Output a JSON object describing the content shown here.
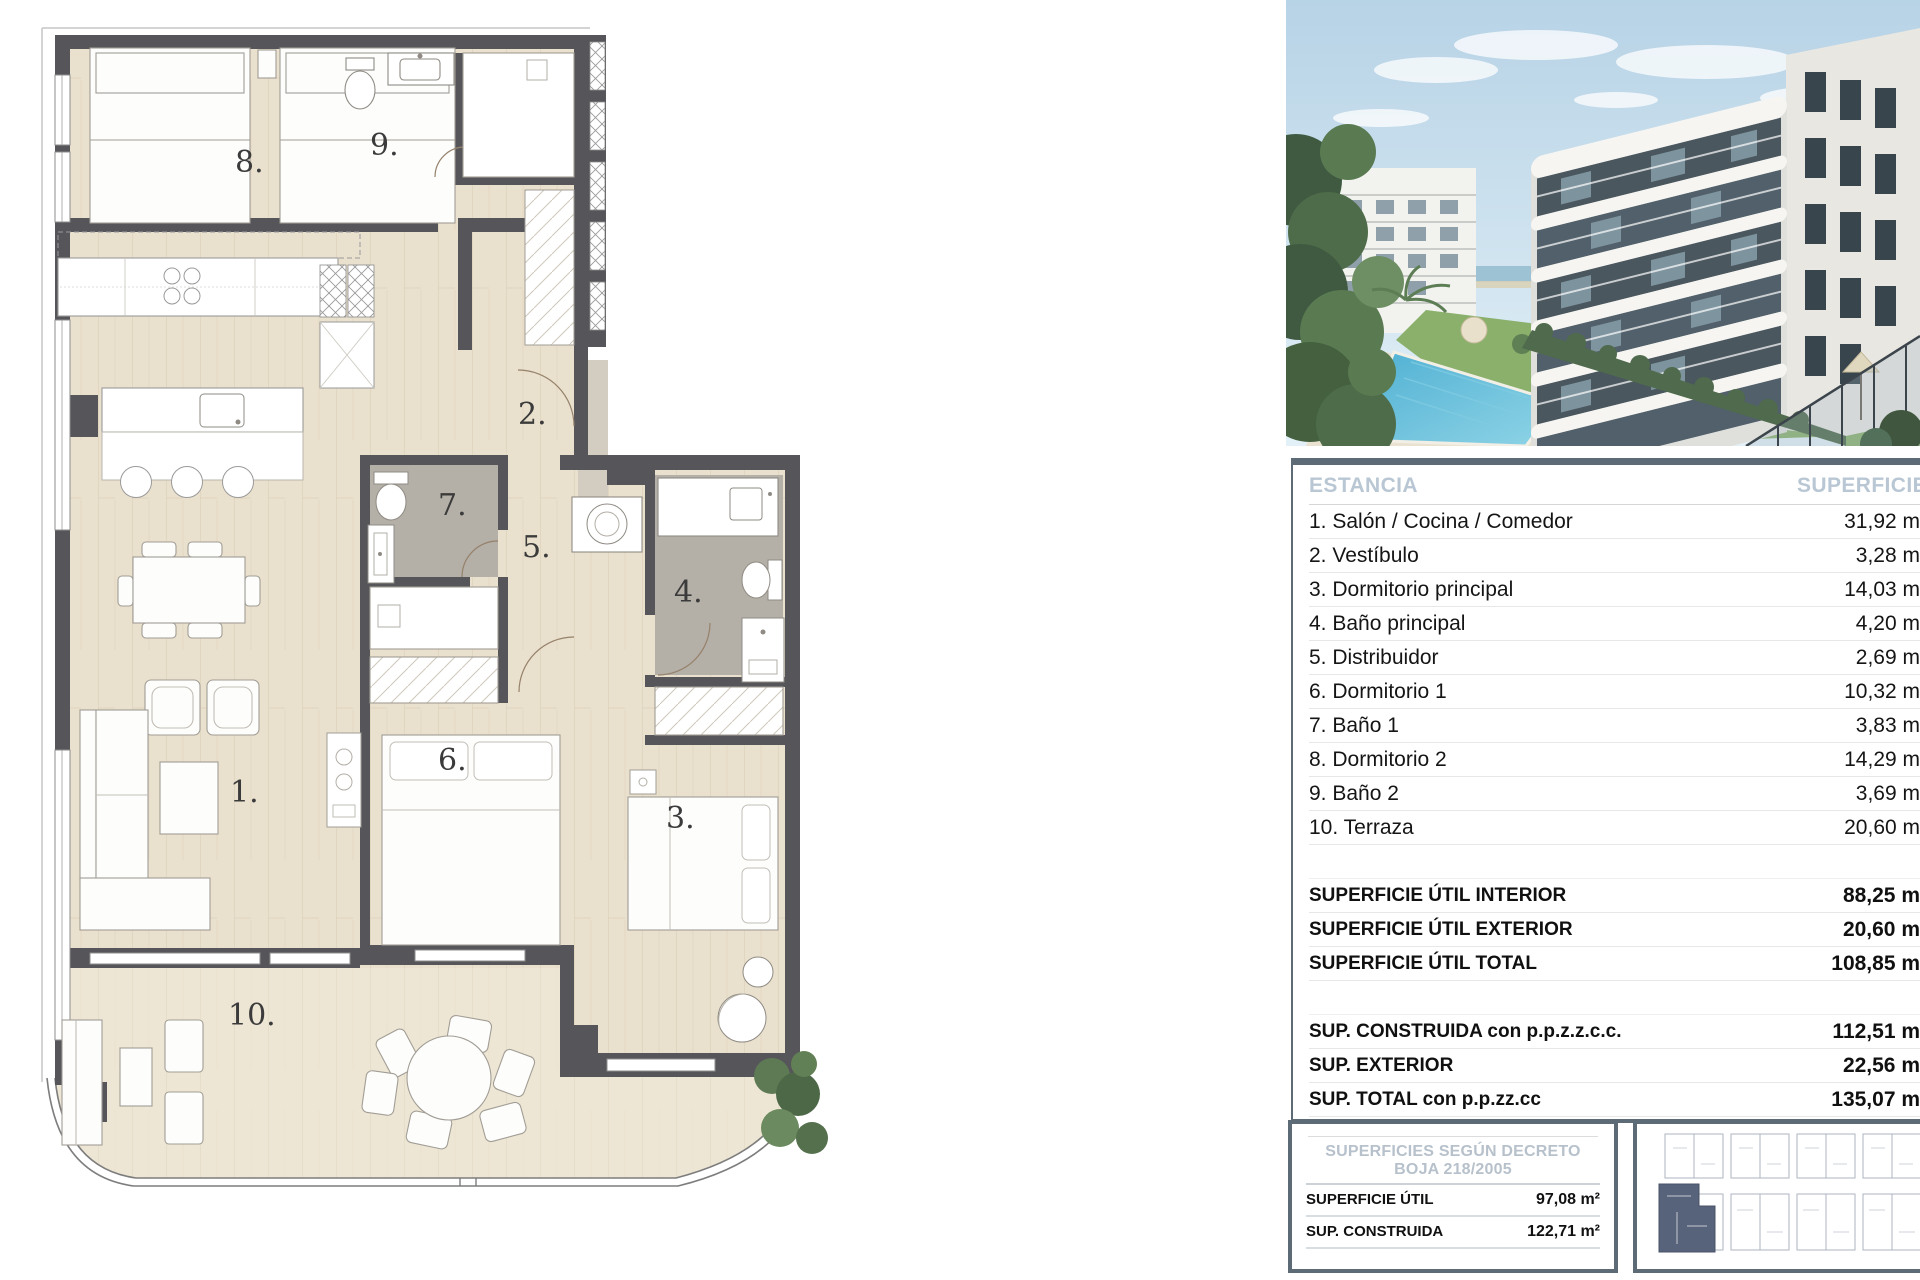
{
  "plan": {
    "labels": [
      "1.",
      "2.",
      "3.",
      "4.",
      "5.",
      "6.",
      "7.",
      "8.",
      "9.",
      "10."
    ]
  },
  "table": {
    "header": {
      "estancia": "ESTANCIA",
      "superficie": "SUPERFICIE"
    },
    "rows": [
      {
        "label": "1. Salón / Cocina / Comedor",
        "value": "31,92 m²"
      },
      {
        "label": "2. Vestíbulo",
        "value": "3,28 m²"
      },
      {
        "label": "3. Dormitorio principal",
        "value": "14,03 m²"
      },
      {
        "label": "4. Baño principal",
        "value": "4,20 m²"
      },
      {
        "label": "5. Distribuidor",
        "value": "2,69 m²"
      },
      {
        "label": "6. Dormitorio 1",
        "value": "10,32 m²"
      },
      {
        "label": "7. Baño 1",
        "value": "3,83 m²"
      },
      {
        "label": "8. Dormitorio 2",
        "value": "14,29 m²"
      },
      {
        "label": "9. Baño 2",
        "value": "3,69 m²"
      },
      {
        "label": "10. Terraza",
        "value": "20,60 m²"
      }
    ],
    "totals": [
      {
        "label": "SUPERFICIE ÚTIL INTERIOR",
        "value": "88,25 m²"
      },
      {
        "label": "SUPERFICIE ÚTIL EXTERIOR",
        "value": "20,60 m²"
      },
      {
        "label": "SUPERFICIE ÚTIL TOTAL",
        "value": "108,85 m²"
      }
    ],
    "constructed": [
      {
        "label": "SUP. CONSTRUIDA con p.p.z.z.c.c.",
        "value": "112,51 m²"
      },
      {
        "label": "SUP. EXTERIOR",
        "value": "22,56 m²"
      },
      {
        "label": "SUP. TOTAL con p.p.zz.cc",
        "value": "135,07 m²"
      }
    ]
  },
  "decree_box": {
    "title": "SUPERFICIES SEGÚN DECRETO BOJA 218/2005",
    "rows": [
      {
        "label": "SUPERFICIE ÚTIL",
        "value": "97,08 m²"
      },
      {
        "label": "SUP. CONSTRUIDA",
        "value": "122,71 m²"
      }
    ]
  },
  "colors": {
    "accent_border": "#5d6b77",
    "table_header_text": "#b9c7d4",
    "wall": "#56565a",
    "wood_floor": "#e9e0cd",
    "bath_floor": "#b4afa7",
    "pool": "#55b6d6"
  }
}
